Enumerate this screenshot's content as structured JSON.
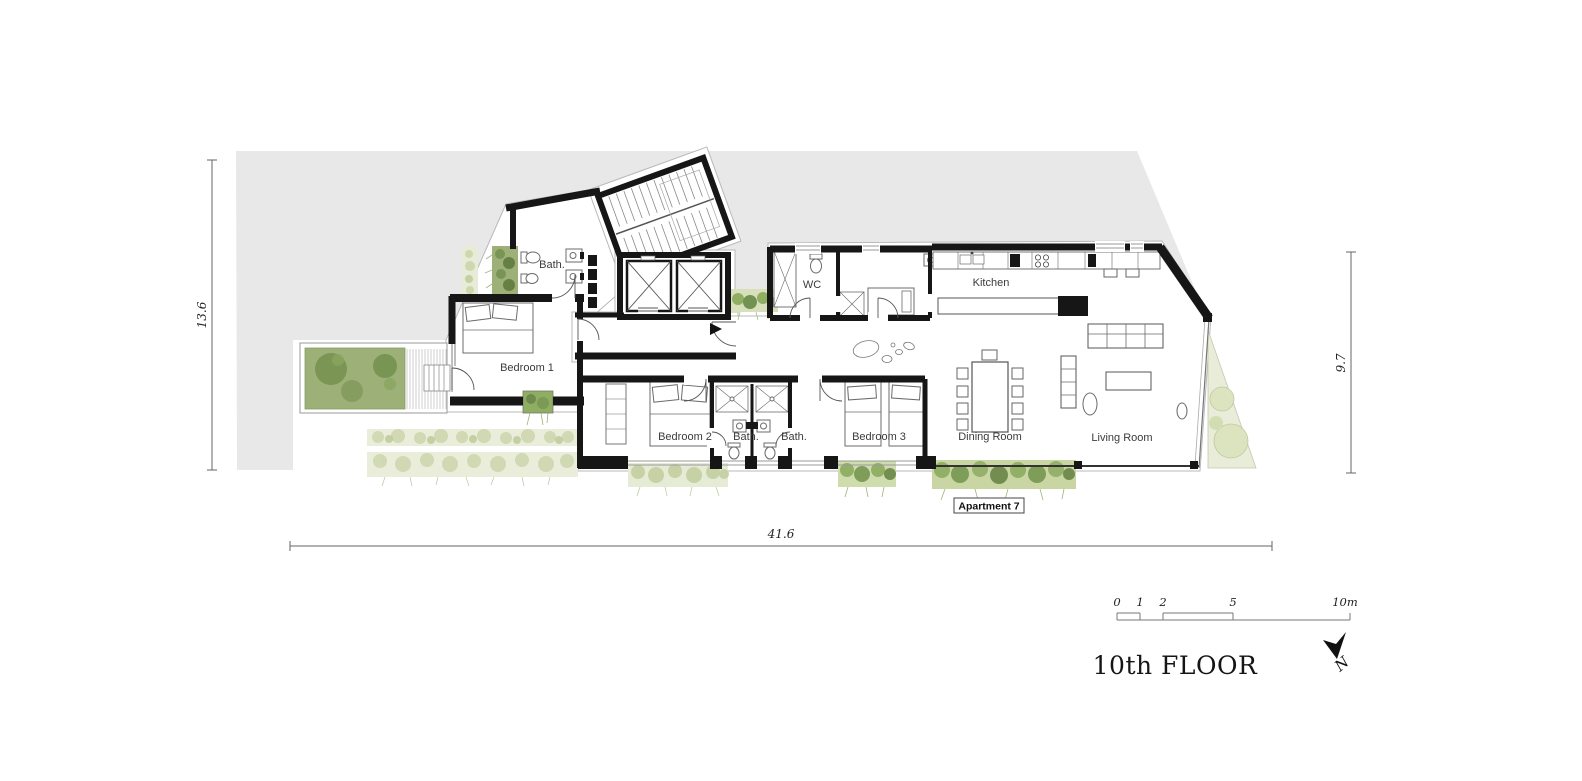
{
  "plan": {
    "floor_title": "10th FLOOR",
    "apartment_tag": "Apartment 7",
    "compass": {
      "label": "N"
    },
    "rooms": [
      {
        "id": "bath-main",
        "label": "Bath."
      },
      {
        "id": "bedroom-1",
        "label": "Bedroom 1"
      },
      {
        "id": "wc",
        "label": "WC"
      },
      {
        "id": "kitchen",
        "label": "Kitchen"
      },
      {
        "id": "bedroom-2",
        "label": "Bedroom 2"
      },
      {
        "id": "bath-1",
        "label": "Bath."
      },
      {
        "id": "bath-2",
        "label": "Bath."
      },
      {
        "id": "bedroom-3",
        "label": "Bedroom 3"
      },
      {
        "id": "dining-room",
        "label": "Dining Room"
      },
      {
        "id": "living-room",
        "label": "Living Room"
      }
    ],
    "dimensions": {
      "left_height": "13.6",
      "right_height": "9.7",
      "bottom_width": "41.6"
    },
    "scale_bar": {
      "ticks": [
        "0",
        "1",
        "2",
        "5",
        "10m"
      ]
    },
    "colors": {
      "site_gray": "#e8e8e8",
      "wall_black": "#161616",
      "garden_green": "#9cb077",
      "foliage_dark": "#6f8a4d",
      "planting_pale": "#e9edda",
      "planting_green": "#8fae62",
      "terrace_pale": "#e9ecd8"
    }
  }
}
